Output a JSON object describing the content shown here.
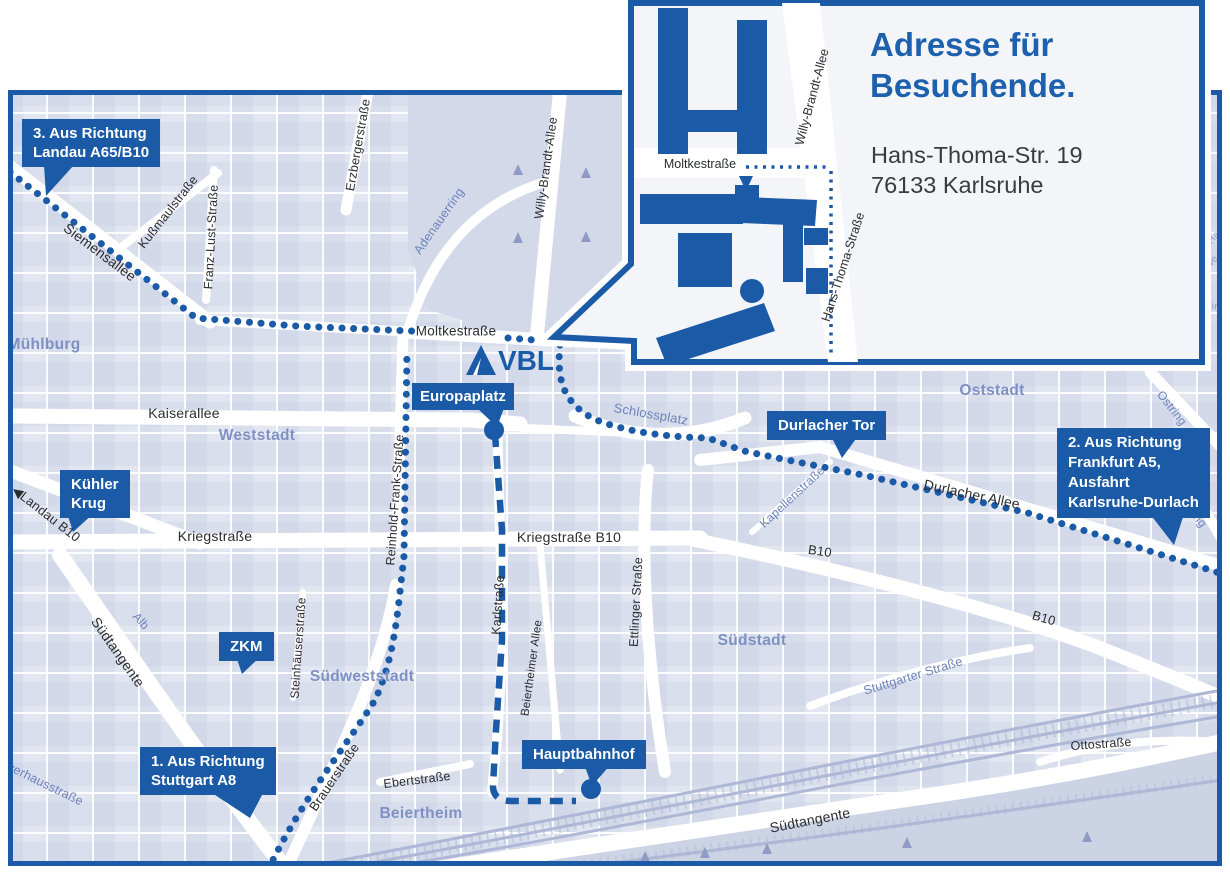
{
  "colors": {
    "brand_blue": "#1a5aa6",
    "title_blue": "#1d60ae",
    "map_background": "#e2e6f0",
    "district_label": "#7e90c4",
    "street_label": "#2b2c30",
    "blue_street_label": "#6d82bb",
    "address_text": "#3b3b3b",
    "street_white": "#ffffff"
  },
  "inset": {
    "title_line1": "Adresse für",
    "title_line2": "Besuchende.",
    "address_line1": "Hans-Thoma-Str. 19",
    "address_line2": "76133 Karlsruhe",
    "streets": {
      "moltkestrasse": "Moltkestraße",
      "willy_brandt_allee": "Willy-Brandt-Allee",
      "hans_thoma_strasse": "Hans-Thoma-Straße"
    }
  },
  "logo": {
    "text": "VBL"
  },
  "callouts": {
    "landau": {
      "line1": "3. Aus Richtung",
      "line2": "Landau A65/B10"
    },
    "frankfurt": {
      "line1": "2. Aus Richtung",
      "line2": "Frankfurt A5,",
      "line3": "Ausfahrt",
      "line4": "Karlsruhe-Durlach"
    },
    "stuttgart": {
      "line1": "1. Aus Richtung",
      "line2": "Stuttgart A8"
    },
    "durlacher_tor": {
      "label": "Durlacher Tor"
    },
    "europaplatz": {
      "label": "Europaplatz"
    },
    "kuehler_krug": {
      "line1": "Kühler",
      "line2": "Krug"
    },
    "zkm": {
      "label": "ZKM"
    },
    "hauptbahnhof": {
      "label": "Hauptbahnhof"
    }
  },
  "markers": {
    "arrow_left": "◀"
  },
  "streets": {
    "siemensallee": "Siemensallee",
    "kussmaulstrasse": "Kußmaulstraße",
    "franz_lust_strasse": "Franz-Lust-Straße",
    "erzbergerstrasse": "Erzbergerstraße",
    "moltkestrasse": "Moltkestraße",
    "kaiserallee": "Kaiserallee",
    "kriegstrasse": "Kriegstraße",
    "kriegstrasse_b10": "Kriegstraße B10",
    "karlstrasse": "Karlstraße",
    "ettlinger_strasse": "Ettlinger Straße",
    "willy_brandt_allee": "Willy-Brandt-Allee",
    "reinhold_frank_strasse": "Reinhold-Frank-Straße",
    "durlacher_allee": "Durlacher Allee",
    "b10_a": "B10",
    "b10_b": "B10",
    "landau_b10": "Landau B10",
    "suedtangente_w": "Südtangente",
    "suedtangente_s": "Südtangente",
    "brauerstrasse": "Brauerstraße",
    "steinhaeuserstrasse": "Steinhäuserstraße",
    "ebertstrasse": "Ebertstraße",
    "ottostrasse": "Ottostraße",
    "beiertheimer_allee": "Beiertheimer Allee",
    "pulverhausstrasse": "Pulverhausstraße"
  },
  "blue_labels": {
    "adenauerring": "Adenauerring",
    "schlossplatz": "Schlossplatz",
    "kapellenstrasse": "Kapellenstraße",
    "ostring_n": "Ostring",
    "ostring_s": "Ostring",
    "stuttgarter_strasse": "Stuttgarter Straße",
    "alb": "Alb"
  },
  "districts": {
    "muehlburg": "Mühlburg",
    "weststadt": "Weststadt",
    "oststadt": "Oststadt",
    "suedstadt": "Südstadt",
    "suedweststadt": "Südweststadt",
    "beiertheim": "Beiertheim"
  },
  "edge_fragments": {
    "f1": "Ha",
    "f2": "we",
    "f3": "ein"
  }
}
